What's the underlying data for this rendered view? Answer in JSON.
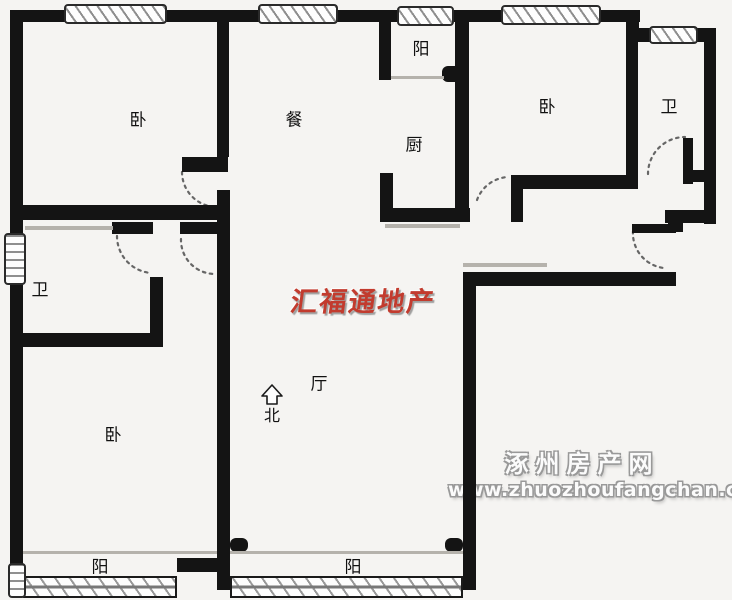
{
  "plan": {
    "background": "#f5f4f2",
    "wall_color": "#141414",
    "labels": [
      {
        "id": "label-bedroom-top-left",
        "text": "卧",
        "x": 138,
        "y": 118
      },
      {
        "id": "label-dining",
        "text": "餐",
        "x": 294,
        "y": 118
      },
      {
        "id": "label-balcony-top",
        "text": "阳",
        "x": 421,
        "y": 47
      },
      {
        "id": "label-kitchen",
        "text": "厨",
        "x": 414,
        "y": 143
      },
      {
        "id": "label-bedroom-top-right",
        "text": "卧",
        "x": 547,
        "y": 105
      },
      {
        "id": "label-bath-top-right",
        "text": "卫",
        "x": 669,
        "y": 105
      },
      {
        "id": "label-bath-left",
        "text": "卫",
        "x": 40,
        "y": 288
      },
      {
        "id": "label-bedroom-bottom-left",
        "text": "卧",
        "x": 113,
        "y": 433
      },
      {
        "id": "label-living",
        "text": "厅",
        "x": 319,
        "y": 382
      },
      {
        "id": "label-balcony-bottom-left",
        "text": "阳",
        "x": 100,
        "y": 565
      },
      {
        "id": "label-balcony-bottom-mid",
        "text": "阳",
        "x": 353,
        "y": 565
      }
    ],
    "north": {
      "label": "北",
      "x": 272,
      "y": 414
    },
    "watermark_red": {
      "text": "汇福通地产",
      "color": "#c23b2e"
    },
    "watermark_site": {
      "line1": "涿州房产网",
      "line2": "www.zhuozhoufangchan.com"
    },
    "walls": [
      {
        "id": "wall-top-outer",
        "x": 10,
        "y": 10,
        "w": 630,
        "h": 12
      },
      {
        "id": "wall-left-outer",
        "x": 10,
        "y": 10,
        "w": 13,
        "h": 568
      },
      {
        "id": "wall-top-right-corner",
        "x": 627,
        "y": 10,
        "w": 12,
        "h": 32
      },
      {
        "id": "wall-bath-tr-top",
        "x": 627,
        "y": 28,
        "w": 89,
        "h": 14
      },
      {
        "id": "wall-right-outer",
        "x": 704,
        "y": 28,
        "w": 12,
        "h": 196
      },
      {
        "id": "wall-bedroom-tl-right",
        "x": 217,
        "y": 10,
        "w": 12,
        "h": 147
      },
      {
        "id": "wall-bedroom-tl-door-stub",
        "x": 182,
        "y": 157,
        "w": 46,
        "h": 15
      },
      {
        "id": "wall-bedroom-tl-bottom",
        "x": 10,
        "y": 205,
        "w": 218,
        "h": 15
      },
      {
        "id": "wall-hall-stub-left",
        "x": 112,
        "y": 222,
        "w": 41,
        "h": 12
      },
      {
        "id": "wall-hall-stub-right",
        "x": 180,
        "y": 222,
        "w": 48,
        "h": 12
      },
      {
        "id": "wall-bath-left-right",
        "x": 150,
        "y": 277,
        "w": 13,
        "h": 70
      },
      {
        "id": "wall-bath-left-bottom",
        "x": 20,
        "y": 333,
        "w": 143,
        "h": 14
      },
      {
        "id": "wall-divider-left",
        "x": 217,
        "y": 190,
        "w": 13,
        "h": 400
      },
      {
        "id": "wall-balcony-left-stub",
        "x": 177,
        "y": 558,
        "w": 40,
        "h": 14
      },
      {
        "id": "wall-dining-balcony-divider",
        "x": 379,
        "y": 10,
        "w": 12,
        "h": 70
      },
      {
        "id": "wall-kitchen-left-stub",
        "x": 380,
        "y": 173,
        "w": 13,
        "h": 49
      },
      {
        "id": "wall-kitchen-bottom",
        "x": 380,
        "y": 208,
        "w": 90,
        "h": 14
      },
      {
        "id": "wall-kitchen-bedroom-divider",
        "x": 455,
        "y": 10,
        "w": 14,
        "h": 212
      },
      {
        "id": "wall-bedroom-tr-bottom",
        "x": 523,
        "y": 175,
        "w": 115,
        "h": 14
      },
      {
        "id": "wall-bedroom-tr-door-stub",
        "x": 511,
        "y": 175,
        "w": 12,
        "h": 47
      },
      {
        "id": "wall-bath-tr-left",
        "x": 626,
        "y": 10,
        "w": 12,
        "h": 172
      },
      {
        "id": "wall-bath-tr-stub-v",
        "x": 683,
        "y": 138,
        "w": 10,
        "h": 46
      },
      {
        "id": "wall-bath-tr-stub-h",
        "x": 687,
        "y": 170,
        "w": 29,
        "h": 12
      },
      {
        "id": "wall-entry-step-h",
        "x": 665,
        "y": 210,
        "w": 51,
        "h": 13
      },
      {
        "id": "wall-entry-step-v",
        "x": 668,
        "y": 210,
        "w": 15,
        "h": 22
      },
      {
        "id": "wall-entry-door-leaf",
        "x": 632,
        "y": 224,
        "w": 44,
        "h": 9
      },
      {
        "id": "wall-living-top-right",
        "x": 463,
        "y": 272,
        "w": 213,
        "h": 14
      },
      {
        "id": "wall-living-right",
        "x": 463,
        "y": 272,
        "w": 13,
        "h": 318
      }
    ],
    "windows": [
      {
        "id": "window-top-1",
        "x": 64,
        "y": 4,
        "w": 103,
        "h": 20,
        "kind": "diag"
      },
      {
        "id": "window-top-2",
        "x": 258,
        "y": 4,
        "w": 80,
        "h": 20,
        "kind": "diag"
      },
      {
        "id": "window-top-3",
        "x": 397,
        "y": 6,
        "w": 57,
        "h": 20,
        "kind": "diag"
      },
      {
        "id": "window-top-4",
        "x": 501,
        "y": 5,
        "w": 100,
        "h": 20,
        "kind": "diag"
      },
      {
        "id": "window-bath-tr",
        "x": 649,
        "y": 26,
        "w": 49,
        "h": 18,
        "kind": "diag"
      },
      {
        "id": "window-left-bath",
        "x": 4,
        "y": 233,
        "w": 22,
        "h": 52,
        "kind": "horiz"
      },
      {
        "id": "window-balcony-left",
        "x": 23,
        "y": 576,
        "w": 154,
        "h": 22,
        "kind": "glaz"
      },
      {
        "id": "window-balcony-mid",
        "x": 230,
        "y": 576,
        "w": 233,
        "h": 22,
        "kind": "glaz"
      },
      {
        "id": "window-corner-bl",
        "x": 8,
        "y": 563,
        "w": 18,
        "h": 35,
        "kind": "horiz"
      }
    ],
    "doors": [
      {
        "id": "door-arc-bedroom-tl",
        "d": "M182,172 A35,35 0 0 0 217,207"
      },
      {
        "id": "door-arc-bath-left",
        "d": "M117,236 A37,37 0 0 0 151,273"
      },
      {
        "id": "door-arc-hall",
        "d": "M181,239 A34,34 0 0 0 215,274"
      },
      {
        "id": "door-arc-bedroom-tr",
        "d": "M477,200 A35,35 0 0 1 508,177"
      },
      {
        "id": "door-arc-bath-tr",
        "d": "M648,174 A37,37 0 0 1 685,137"
      },
      {
        "id": "door-arc-entry",
        "d": "M633,231 A35,35 0 0 0 664,268"
      }
    ],
    "knobs": [
      {
        "id": "knob-kitchen-balcony",
        "x": 442,
        "y": 66,
        "w": 19,
        "h": 16
      },
      {
        "id": "knob-divider-left",
        "x": 230,
        "y": 538,
        "w": 18,
        "h": 14
      },
      {
        "id": "knob-living-right",
        "x": 445,
        "y": 538,
        "w": 18,
        "h": 14
      }
    ],
    "thin_lines": [
      {
        "id": "line-bath-left-top",
        "x": 25,
        "y": 226,
        "w": 88,
        "h": 4
      },
      {
        "id": "line-kitchen-shadow",
        "x": 385,
        "y": 224,
        "w": 75,
        "h": 4
      },
      {
        "id": "line-living-tr-shadow",
        "x": 463,
        "y": 263,
        "w": 84,
        "h": 4
      },
      {
        "id": "line-balcony-top-door",
        "x": 391,
        "y": 76,
        "w": 53,
        "h": 3
      },
      {
        "id": "line-balcony-left-door",
        "x": 23,
        "y": 551,
        "w": 194,
        "h": 3
      },
      {
        "id": "line-balcony-mid-door",
        "x": 230,
        "y": 551,
        "w": 233,
        "h": 3
      }
    ]
  }
}
